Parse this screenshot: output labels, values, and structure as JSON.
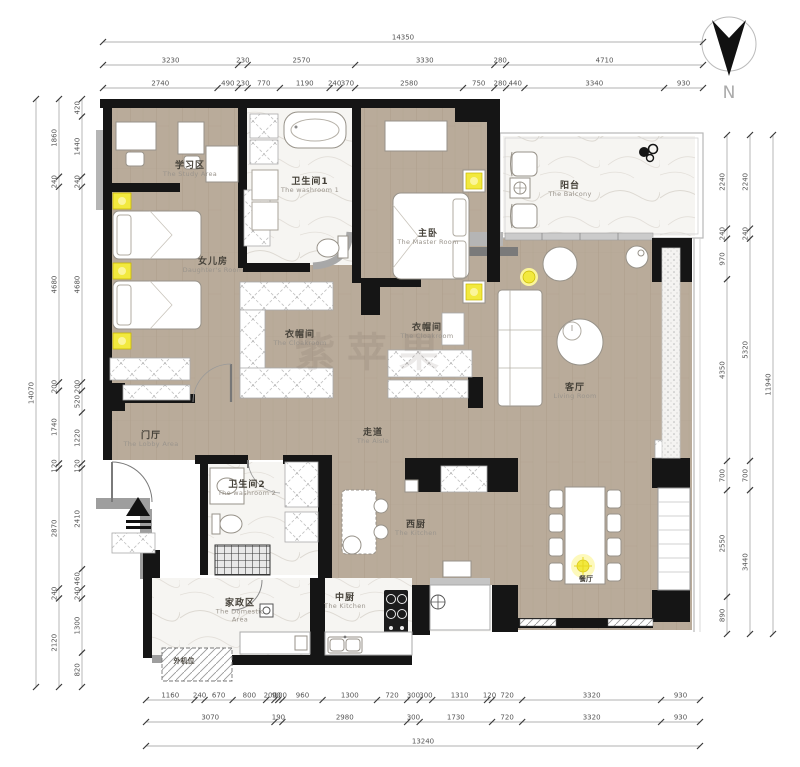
{
  "watermark": "紫苹果",
  "north": {
    "label": "N"
  },
  "rooms": [
    {
      "id": "study",
      "zh": "学习区",
      "en": "The Study Area"
    },
    {
      "id": "daughter",
      "zh": "女儿房",
      "en": "Daughter's Room"
    },
    {
      "id": "washroom1",
      "zh": "卫生间1",
      "en": "The washroom 1"
    },
    {
      "id": "master",
      "zh": "主卧",
      "en": "The Master Room"
    },
    {
      "id": "balcony",
      "zh": "阳台",
      "en": "The Balcony"
    },
    {
      "id": "cloak1",
      "zh": "衣帽间",
      "en": "The Cloakroom"
    },
    {
      "id": "cloak2",
      "zh": "衣帽间",
      "en": "The Cloakroom"
    },
    {
      "id": "living",
      "zh": "客厅",
      "en": "Living Room"
    },
    {
      "id": "lobby",
      "zh": "门厅",
      "en": "The Lobby Area"
    },
    {
      "id": "aisle",
      "zh": "走道",
      "en": "The Aisle"
    },
    {
      "id": "washroom2",
      "zh": "卫生间2",
      "en": "The washroom 2"
    },
    {
      "id": "westkitchen",
      "zh": "西厨",
      "en": "The Kitchen"
    },
    {
      "id": "kitchen",
      "zh": "中厨",
      "en": "The Kitchen"
    },
    {
      "id": "domestic",
      "zh": "家政区",
      "en": "The Domestic Area"
    },
    {
      "id": "dining",
      "zh": "餐厅",
      "en": ""
    },
    {
      "id": "acunit",
      "zh": "外机位",
      "en": ""
    }
  ],
  "dimensions": {
    "top": {
      "row_total": [
        14350
      ],
      "row2": [
        3230,
        230,
        2570,
        3330,
        280,
        4710
      ],
      "row3": [
        2740,
        490,
        230,
        770,
        1190,
        240,
        370,
        2580,
        750,
        280,
        440,
        3340,
        930
      ]
    },
    "bottom": {
      "row1": [
        1160,
        240,
        670,
        800,
        200,
        90,
        100,
        960,
        1300,
        720,
        300,
        300,
        1310,
        120,
        720,
        3320,
        930
      ],
      "row2": [
        3070,
        190,
        2980,
        300,
        1730,
        720,
        3320,
        930
      ],
      "row_total": [
        13240
      ]
    },
    "left": {
      "row_total": [
        14070
      ],
      "mid": [
        1860,
        240,
        4680,
        200,
        1740,
        120,
        2870,
        240,
        2120
      ],
      "inner": [
        420,
        1440,
        240,
        4680,
        200,
        520,
        1220,
        120,
        2410,
        460,
        240,
        1300,
        820
      ]
    },
    "right": {
      "inner": [
        2240,
        240,
        970,
        4350,
        700,
        2550,
        890
      ],
      "mid": [
        2240,
        240,
        5320,
        700,
        3440
      ],
      "row_total": [
        11940
      ]
    }
  },
  "colors": {
    "wall": "#151515",
    "wood_floor": "#b9ab9a",
    "marble_floor": "#f6f5f2",
    "accent_yellow": "#f2e93e",
    "dimension_text": "#555555"
  }
}
